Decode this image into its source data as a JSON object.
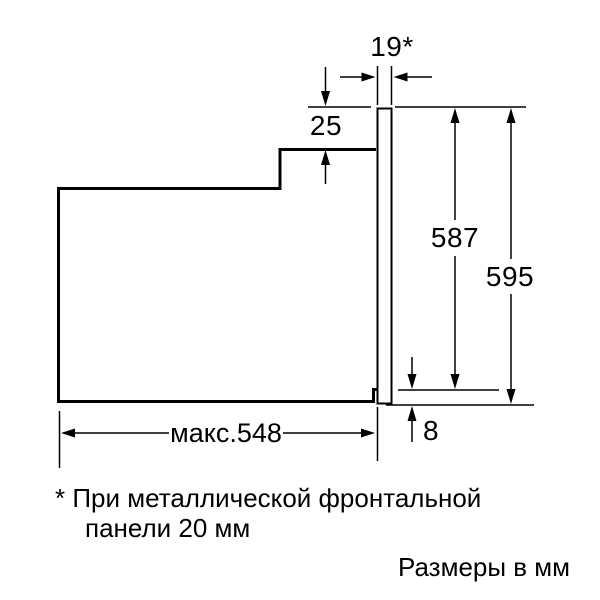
{
  "diagram": {
    "dim_panel_thickness": "19*",
    "dim_top_step": "25",
    "dim_inner_height": "587",
    "dim_total_height": "595",
    "dim_bottom_gap": "8",
    "dim_max_depth": "макс.548"
  },
  "footnote": {
    "line1": "* При металлической фронтальной",
    "line2": "панели 20 мм"
  },
  "caption": "Размеры в мм",
  "colors": {
    "line": "#000000",
    "background": "#ffffff"
  }
}
